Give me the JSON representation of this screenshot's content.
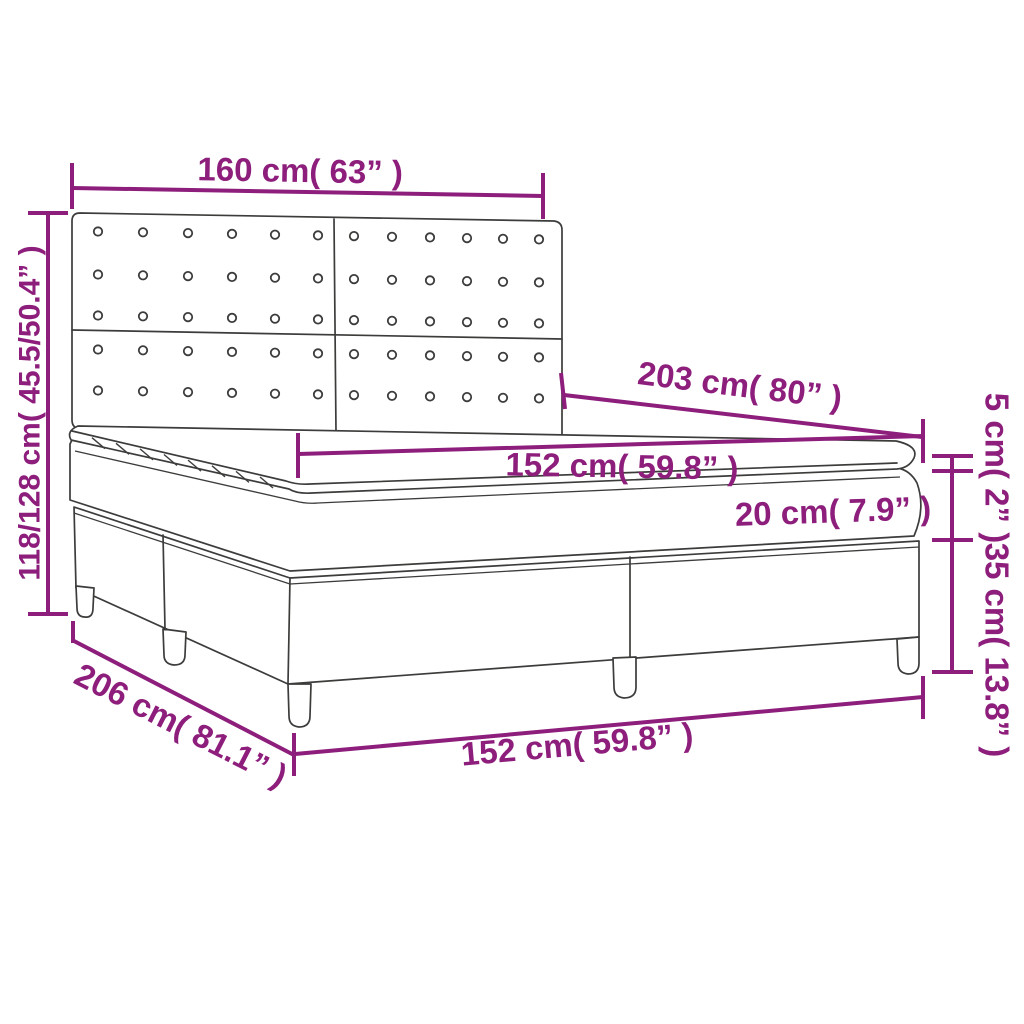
{
  "title": "Box spring bed dimension diagram",
  "colors": {
    "dimension_color": "#8D1E7C",
    "outline_color": "#3C3C3B",
    "background": "#FFFFFF"
  },
  "labels": {
    "headboard_width": "160 cm( 63” )",
    "total_height": "118/128 cm( 45.5/50.4” )",
    "total_length": "203 cm( 80” )",
    "mattress_width": "152 cm( 59.8” )",
    "mattress_thickness": "20 cm( 7.9” )",
    "topper_thickness": "5 cm( 2” )",
    "base_leg_height": "35 cm( 13.8” )",
    "total_depth": "206 cm( 81.1” )",
    "base_width": "152 cm( 59.8” )"
  }
}
